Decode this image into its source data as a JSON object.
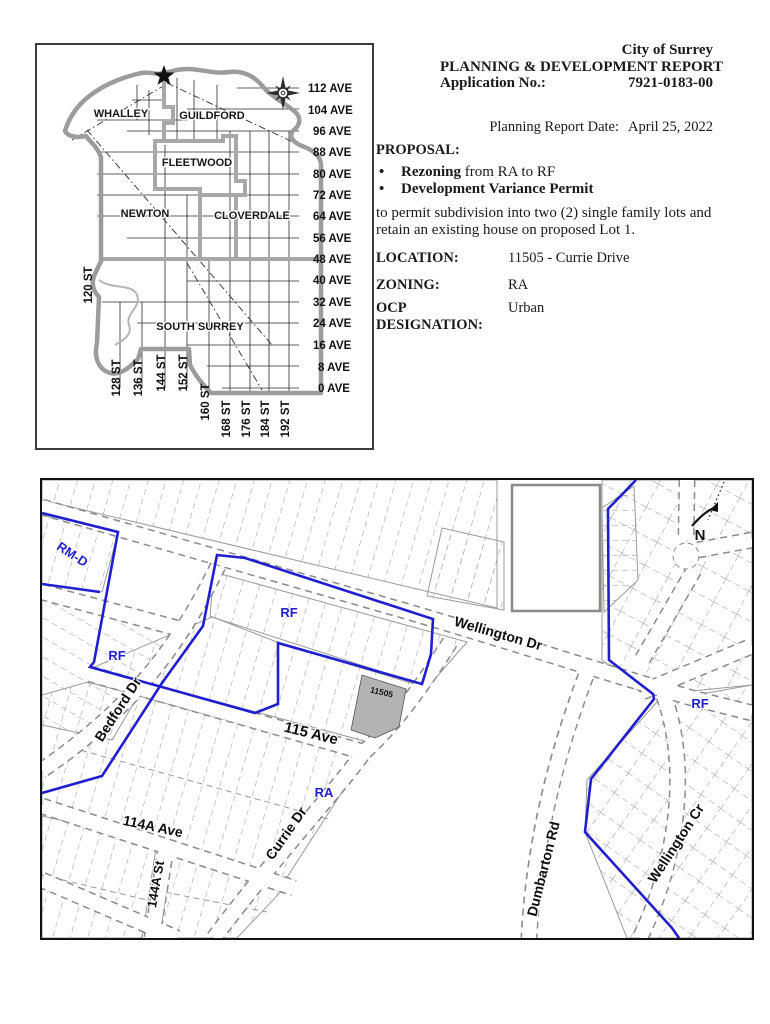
{
  "document": {
    "agency": "City of Surrey",
    "report_title": "PLANNING & DEVELOPMENT REPORT",
    "application_label": "Application No.:",
    "application_no": "7921-0183-00",
    "report_date_label": "Planning Report Date:",
    "report_date": "April 25, 2022",
    "proposal_label": "PROPOSAL:",
    "bullet_glyph": "•",
    "bullet1_bold": "Rezoning",
    "bullet1_rest": " from RA to RF",
    "bullet2": "Development Variance Permit",
    "proposal_text": "to permit subdivision into two (2) single family lots and retain an existing house on proposed Lot 1.",
    "location_label": "LOCATION:",
    "location_value": "11505 - Currie Drive",
    "zoning_label": "ZONING:",
    "zoning_value": "RA",
    "ocp_label": "OCP DESIGNATION:",
    "ocp_value": "Urban"
  },
  "overview_map": {
    "regions": [
      "WHALLEY",
      "GUILDFORD",
      "FLEETWOOD",
      "NEWTON",
      "CLOVERDALE",
      "SOUTH SURREY"
    ],
    "avenues": [
      "112 AVE",
      "104 AVE",
      "96 AVE",
      "88 AVE",
      "80 AVE",
      "72 AVE",
      "64 AVE",
      "56 AVE",
      "48 AVE",
      "40 AVE",
      "32 AVE",
      "24 AVE",
      "16 AVE",
      "8 AVE",
      "0 AVE"
    ],
    "streets": [
      "120 ST",
      "128 ST",
      "136 ST",
      "144 ST",
      "152 ST",
      "160 ST",
      "168 ST",
      "176 ST",
      "184 ST",
      "192 ST"
    ]
  },
  "zoning_map": {
    "streets": [
      {
        "label": "Wellington Dr"
      },
      {
        "label": "Bedford Dr"
      },
      {
        "label": "115 Ave"
      },
      {
        "label": "114A Ave"
      },
      {
        "label": "Currie Dr"
      },
      {
        "label": "144A St"
      },
      {
        "label": "Dumbarton Rd"
      },
      {
        "label": "Wellington Cr"
      }
    ],
    "zones": [
      {
        "label": "RM-D"
      },
      {
        "label": "RF"
      },
      {
        "label": "RF"
      },
      {
        "label": "RF"
      },
      {
        "label": "RA"
      }
    ],
    "subject_parcel": "11505",
    "north_label": "N"
  },
  "colors": {
    "zone_boundary_blue": "#1f1fd0",
    "subject_parcel_fill": "#b3b3b3",
    "city_boundary_gray": "#9c9c9c"
  }
}
